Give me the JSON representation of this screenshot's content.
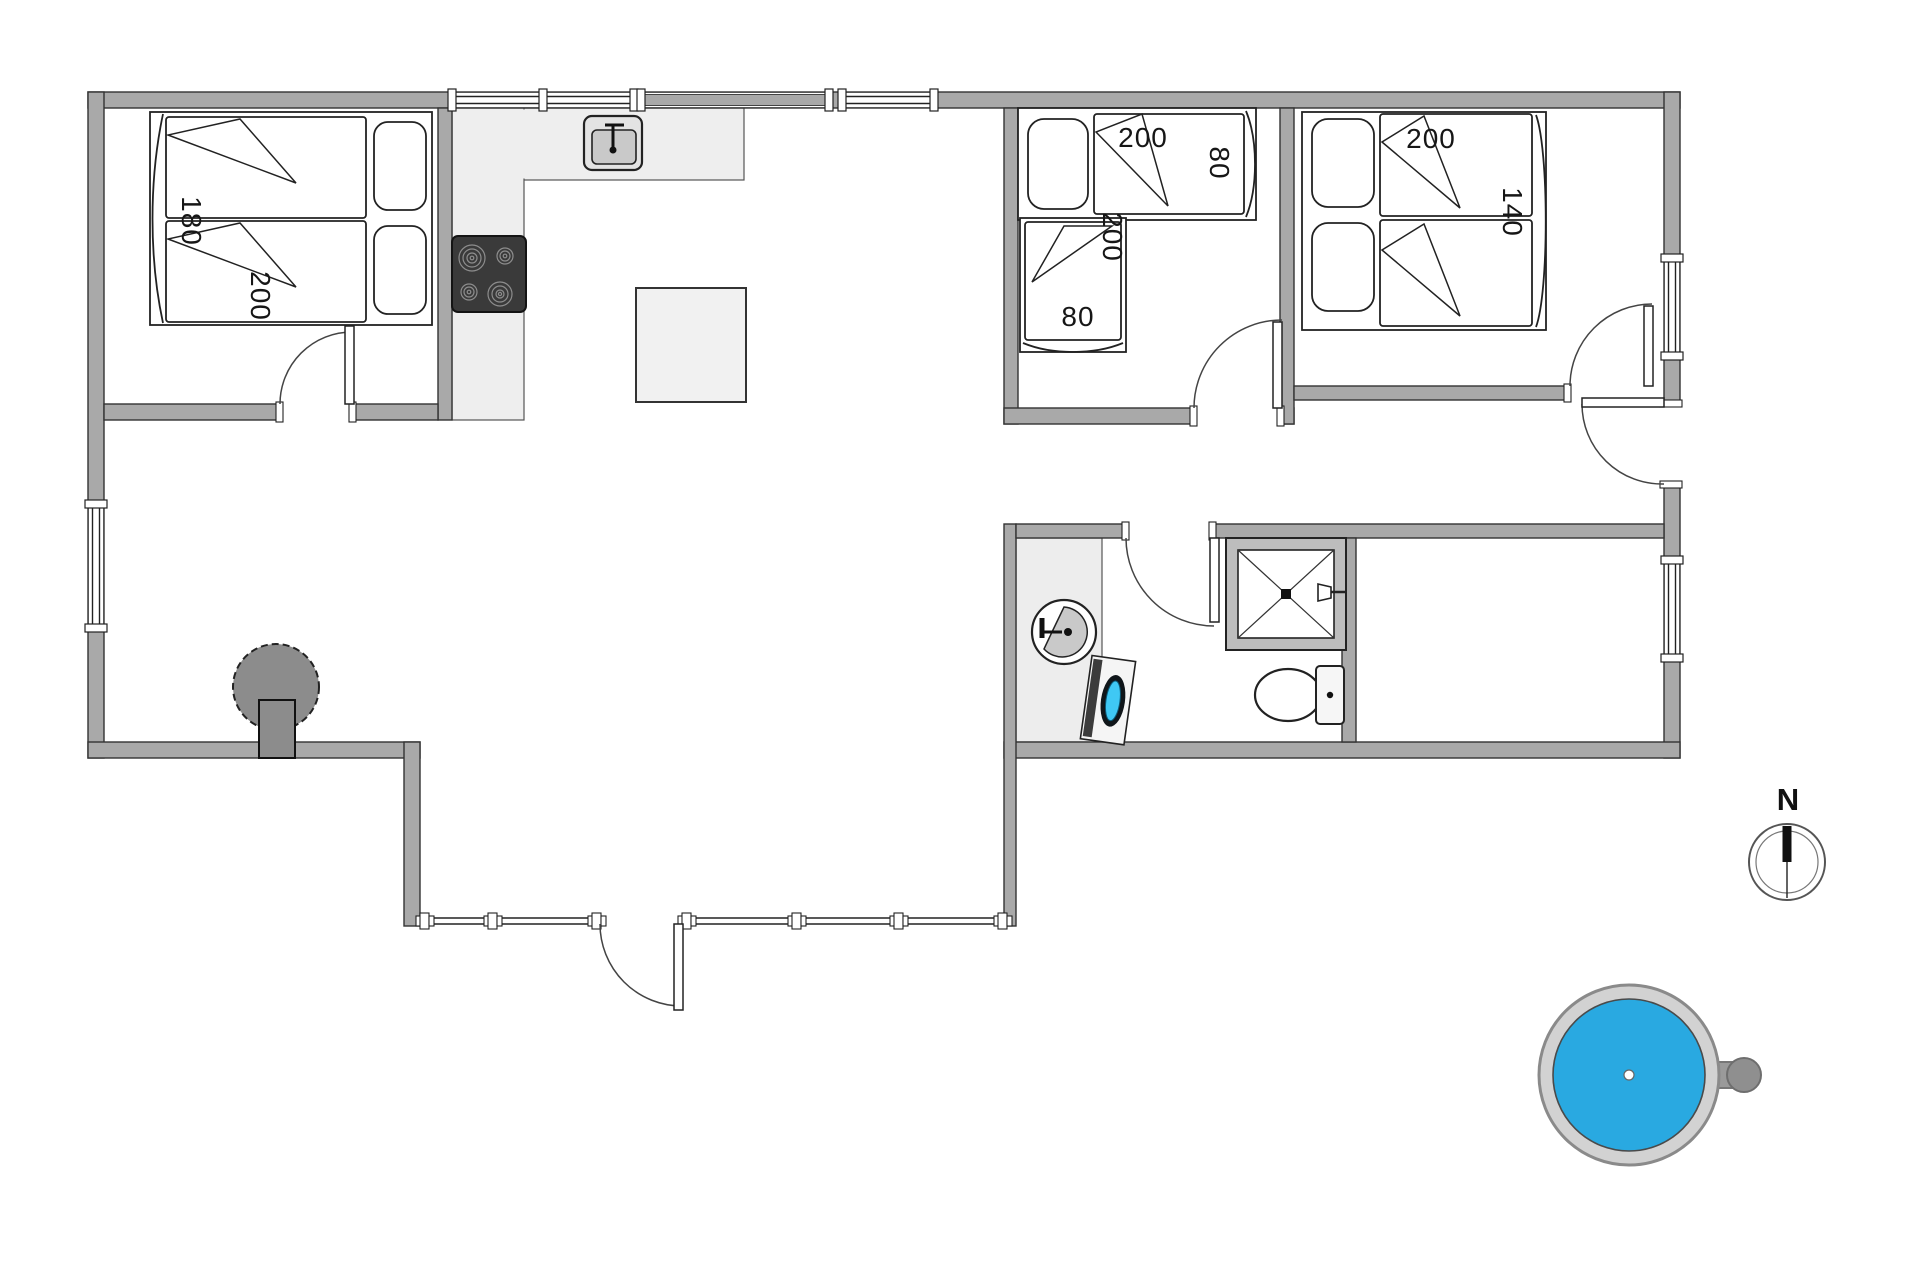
{
  "plan": {
    "type": "floor-plan",
    "labels": {
      "bed1_width": "180",
      "bed1_length": "200",
      "bed2a_length": "200",
      "bed2a_width": "80",
      "bed2b_length": "200",
      "bed2b_width": "80",
      "bed3_length": "200",
      "bed3_width": "140",
      "compass_north": "N"
    },
    "colors": {
      "wall": "#a9a9a9",
      "counter": "#eeeeee",
      "stove_top": "#3a3a3a",
      "wood_stove": "#8c8c8c",
      "hot_tub_water": "#29a9e1",
      "washer_door": "#3fc8f4"
    },
    "fixtures": [
      "double-bed-180x200",
      "single-bed-200x80",
      "single-bed-200x80",
      "double-bed-200x140",
      "kitchen-sink",
      "stove-top",
      "dining-table",
      "wood-burning-stove",
      "washbasin",
      "washing-machine",
      "shower",
      "toilet",
      "hot-tub",
      "compass"
    ]
  }
}
